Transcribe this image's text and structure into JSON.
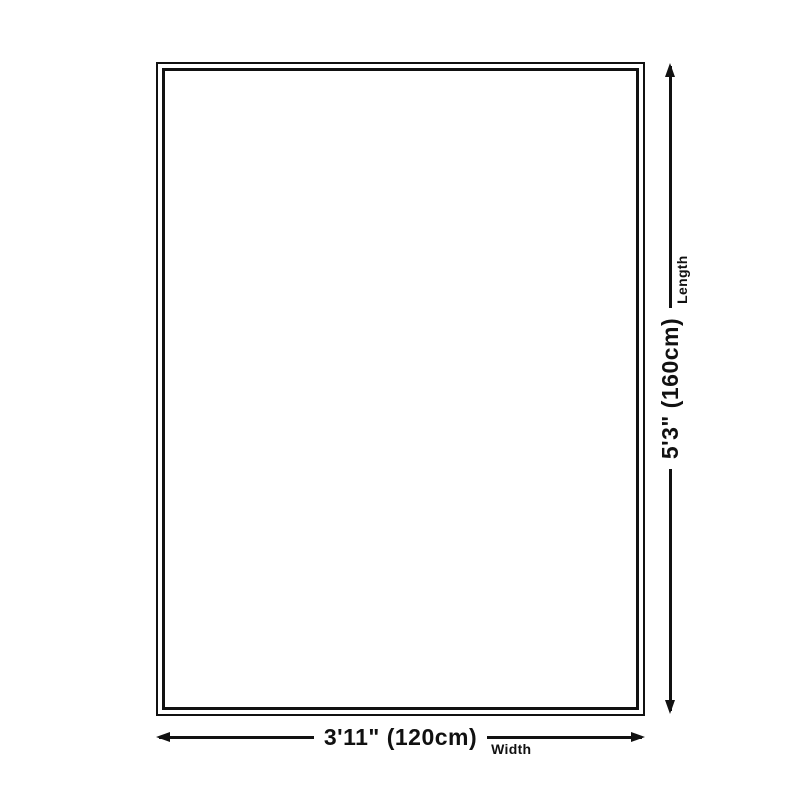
{
  "diagram": {
    "background": "#ffffff",
    "line_color": "#111111",
    "width_dim": {
      "value": "3'11\" (120cm)",
      "label": "Width"
    },
    "length_dim": {
      "value": "5'3\" (160cm)",
      "label": "Length"
    }
  }
}
